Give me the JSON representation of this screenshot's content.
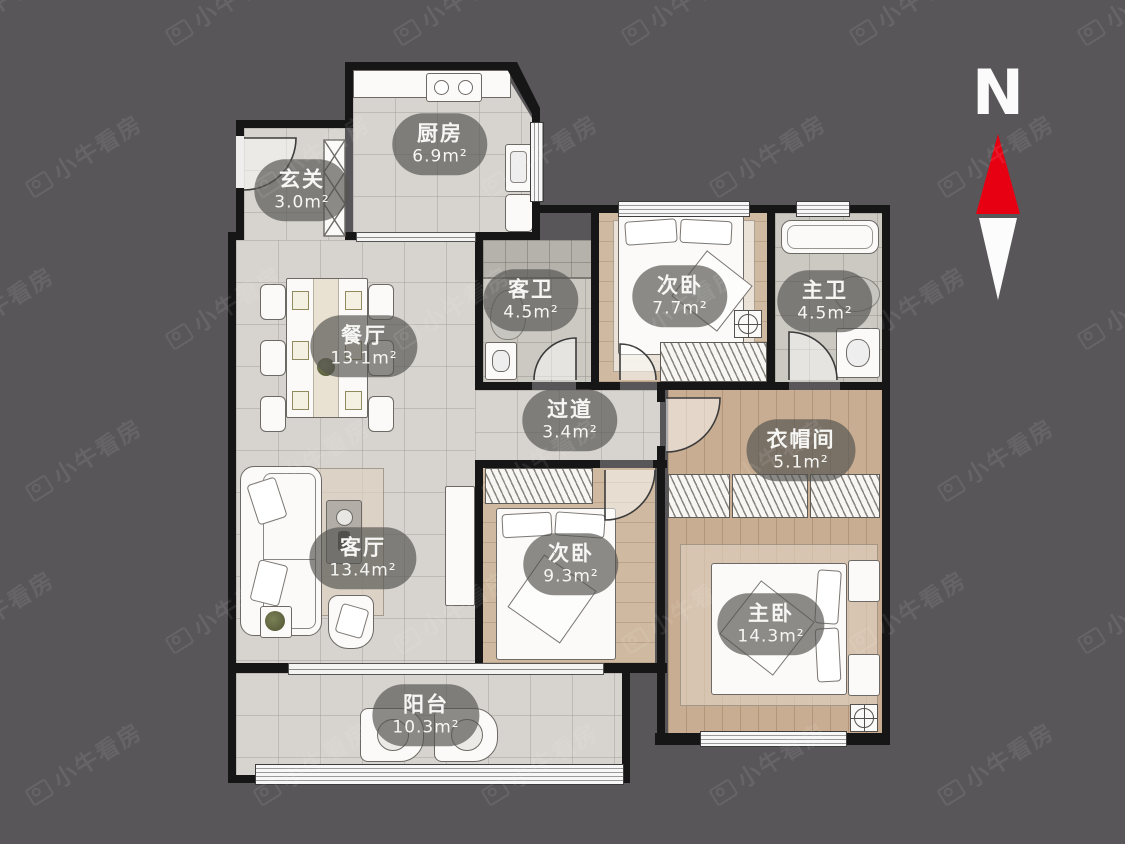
{
  "watermark": {
    "text": "小牛看房"
  },
  "compass": {
    "label": "N"
  },
  "colors": {
    "background": "#585659",
    "wall": "#161616",
    "north_red": "#e60012",
    "label_pill": "rgba(86,84,81,0.68)"
  },
  "rooms": [
    {
      "id": "entry",
      "name": "玄关",
      "area": "3.0m²"
    },
    {
      "id": "kitchen",
      "name": "厨房",
      "area": "6.9m²"
    },
    {
      "id": "guest-bath",
      "name": "客卫",
      "area": "4.5m²"
    },
    {
      "id": "bedroom-2a",
      "name": "次卧",
      "area": "7.7m²"
    },
    {
      "id": "master-bath",
      "name": "主卫",
      "area": "4.5m²"
    },
    {
      "id": "dining",
      "name": "餐厅",
      "area": "13.1m²"
    },
    {
      "id": "hallway",
      "name": "过道",
      "area": "3.4m²"
    },
    {
      "id": "closet",
      "name": "衣帽间",
      "area": "5.1m²"
    },
    {
      "id": "living",
      "name": "客厅",
      "area": "13.4m²"
    },
    {
      "id": "bedroom-2b",
      "name": "次卧",
      "area": "9.3m²"
    },
    {
      "id": "master-bedroom",
      "name": "主卧",
      "area": "14.3m²"
    },
    {
      "id": "balcony",
      "name": "阳台",
      "area": "10.3m²"
    }
  ]
}
